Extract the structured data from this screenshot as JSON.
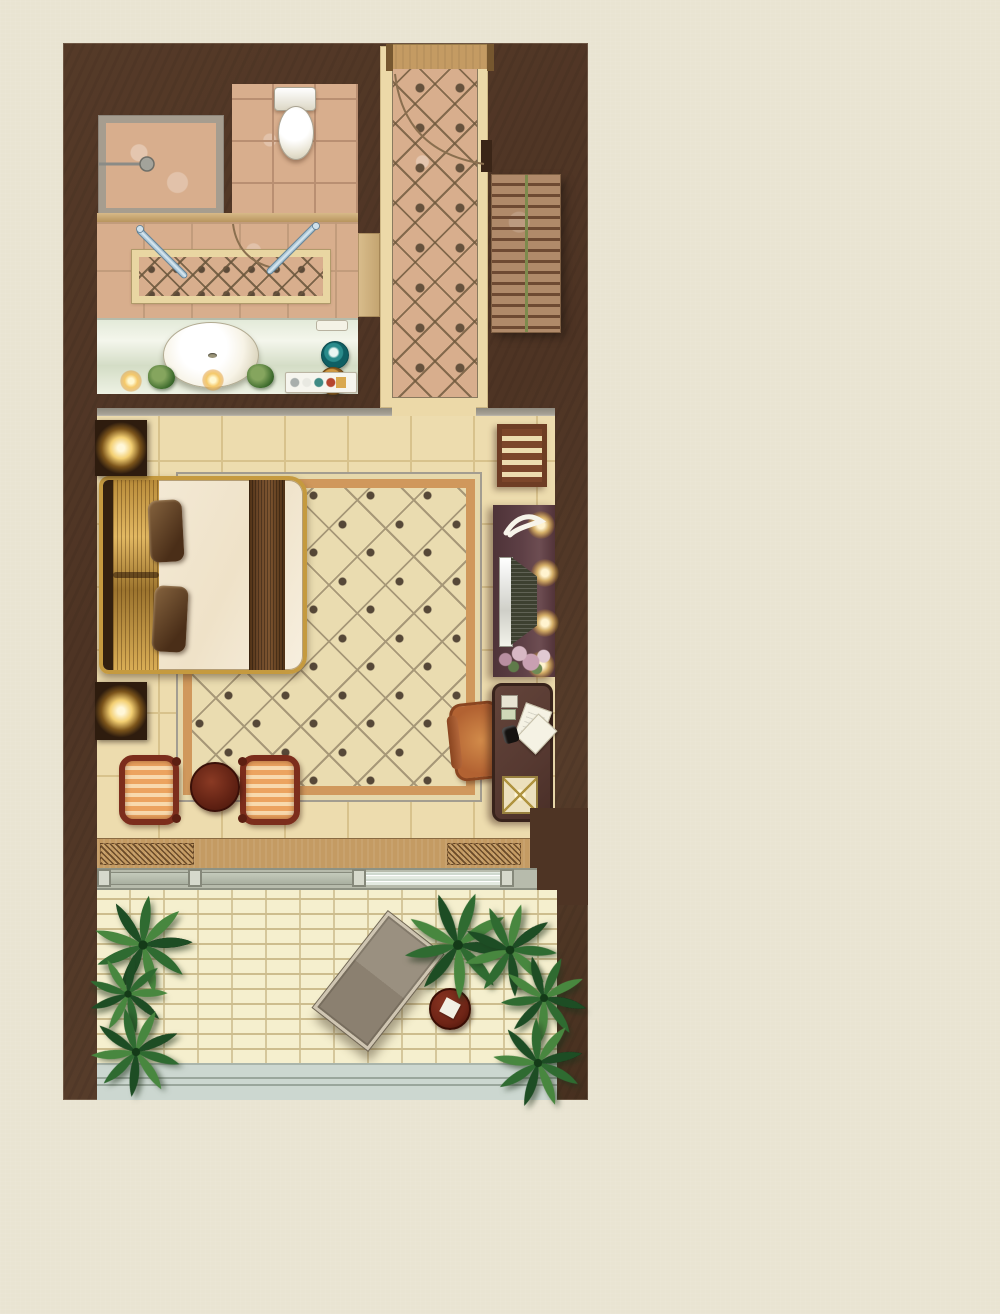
{
  "meta": {
    "kind": "architectural-floor-plan-rendering",
    "description": "Top-down rendered floor plan of a studio hotel suite: bathroom with shower, toilet and vanity at top, entry corridor with diagonal marble tile, exterior stair run beside the corridor, bedroom with king bed, area rug, TV console, writing desk and seating, and a brick-paved terrace with palms, lounge chair and side table at the bottom.",
    "canvas": {
      "width": 1000,
      "height": 1314
    },
    "visible_text": []
  },
  "palette": {
    "page_bg": "#e9e4d2",
    "wall": "#4e3424",
    "tile_pink": "#d8ae8d",
    "tile_line": "#b98f72",
    "marble_cream": "#ecd9a8",
    "floor_cream": "#eddcae",
    "floor_line": "#d8c28c",
    "rug_field": "#eadcb0",
    "rug_border": "#d0985c",
    "rug_edge": "#a39d90",
    "rug_line": "#a79878",
    "rug_dot": "#564838",
    "bed_gold": "#c59a3f",
    "bed_duvet": "#f5ecda",
    "bed_runner": "#6b4627",
    "bed_headboard": "#33200f",
    "nightstand": "#2e1c0e",
    "rack_wood": "#6e3d24",
    "console_plum": "#5d3f45",
    "desk_wood": "#563931",
    "chair_frame": "#7c2d1c",
    "cushion_stripe_a": "#eca35f",
    "cushion_stripe_b": "#f8d9ad",
    "table_maroon": "#5e2012",
    "counter_green": "#d4ddc6",
    "sink_white": "#f7f3e6",
    "glass_steel": "#9fc0d4",
    "threshold_tan": "#c49b63",
    "slider_track": "#b7bbac",
    "slider_glass": "#e3eae1",
    "brick": "#f5efce",
    "brick_grout": "#cdbd8e",
    "band_blue": "#ccd7d0",
    "band_line": "#9aa69c",
    "palm_dark": "#1d4d24",
    "palm_mid": "#2f6b31",
    "palm_light": "#48873f",
    "stairs_bg": "#b08a6a",
    "stairs_tread": "#6e4a33",
    "stairs_line": "#7d8a4d",
    "door_arc": "#8a6f4f"
  },
  "rooms": [
    {
      "name": "bathroom",
      "features": [
        "shower-enclosure",
        "toilet",
        "decorative-tile-inlay",
        "glass-doors",
        "vanity-counter",
        "oval-sink",
        "plants",
        "candles",
        "amenity-dishes"
      ]
    },
    {
      "name": "entry-corridor",
      "features": [
        "diagonal-marble-tile",
        "entry-threshold",
        "door-swing-arc"
      ]
    },
    {
      "name": "bedroom",
      "features": [
        "king-bed",
        "gold-bed-frame",
        "pillows",
        "bed-runner",
        "nightstands-with-lamps",
        "area-rug",
        "luggage-rack",
        "tv-console",
        "flowers",
        "writing-desk",
        "desk-chair",
        "tub-chairs",
        "round-side-table"
      ]
    },
    {
      "name": "terrace",
      "features": [
        "brick-paving",
        "palm-plants",
        "lounge-chair",
        "round-side-table",
        "railing-band",
        "sliding-glass-doors",
        "threshold-step"
      ]
    }
  ],
  "exterior": [
    "stair-run-beside-corridor"
  ]
}
